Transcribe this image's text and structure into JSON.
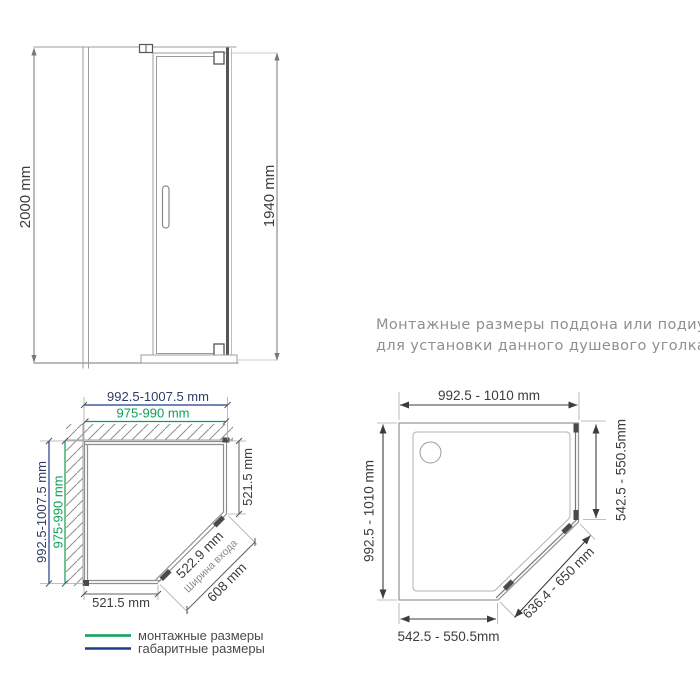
{
  "note": {
    "line1": "Монтажные размеры поддона или подиума",
    "line2": "для установки данного душевого уголка"
  },
  "elevation": {
    "total_height": "2000 mm",
    "glass_height": "1940 mm"
  },
  "plan_enclosure": {
    "width_overall": "992.5-1007.5 mm",
    "width_mounting": "975-990 mm",
    "depth_overall": "992.5-1007.5 mm",
    "depth_mounting": "975-990 mm",
    "right_side": "521.5 mm",
    "bottom_side": "521.5 mm",
    "door_glass": "522.9 mm",
    "door_caption": "Ширина входа",
    "entry_opening": "608 mm"
  },
  "plan_tray": {
    "top": "992.5 - 1010 mm",
    "left": "992.5 - 1010 mm",
    "right": "542.5 - 550.5mm",
    "bottom": "542.5 - 550.5mm",
    "diagonal": "636.4 - 650 mm"
  },
  "legend": {
    "items": [
      {
        "label": "монтажные размеры",
        "color": "#0aa155"
      },
      {
        "label": "габаритные размеры",
        "color": "#1e3c8c"
      }
    ]
  },
  "colors": {
    "mounting_green": "#0aa155",
    "overall_navy": "#1e3c8c",
    "dim_text": "#3c3c3c",
    "drawing_line": "#9c9c9c",
    "note_gray": "#8f8f8f"
  }
}
